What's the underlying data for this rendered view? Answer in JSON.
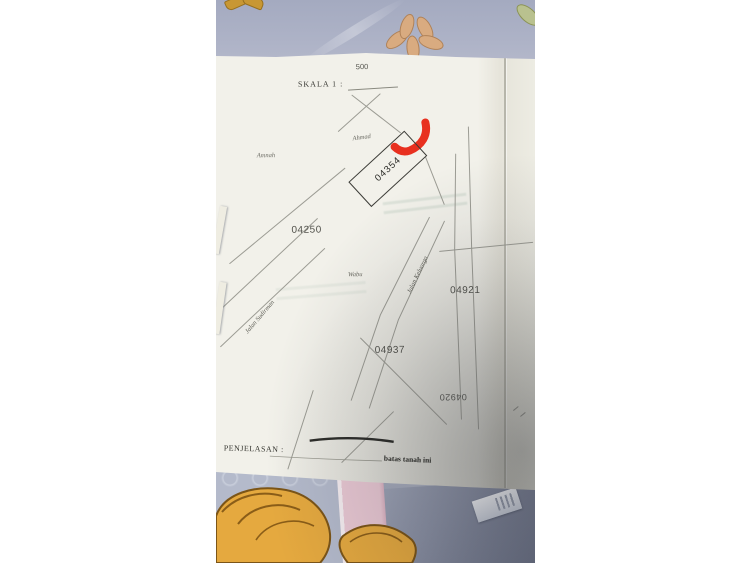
{
  "document": {
    "top_number": "500",
    "scale_label": "SKALA 1 :",
    "plot_main": {
      "id": "04354"
    },
    "plots": {
      "p04250": "04250",
      "p04921": "04921",
      "p04937": "04937",
      "p04920_upside_down": "04920"
    },
    "names": {
      "top": "Ahmad",
      "left": "Amnah",
      "middle": "Wabu"
    },
    "roads": {
      "right": "Jalan Keluarga",
      "left": "Jalan Sudirman"
    },
    "footer": {
      "label": "PENJELASAN :",
      "note": "batas tanah ini"
    }
  },
  "annotation": {
    "marker_color": "#e8301f"
  },
  "colors": {
    "fabric_blue": "#a9afc4",
    "paper": "#f2f1ea",
    "map_line": "#9c9c94",
    "hair_gold": "#e5a93f",
    "pink_band": "#eac9d4",
    "shadow_corner": "#6d7386"
  }
}
